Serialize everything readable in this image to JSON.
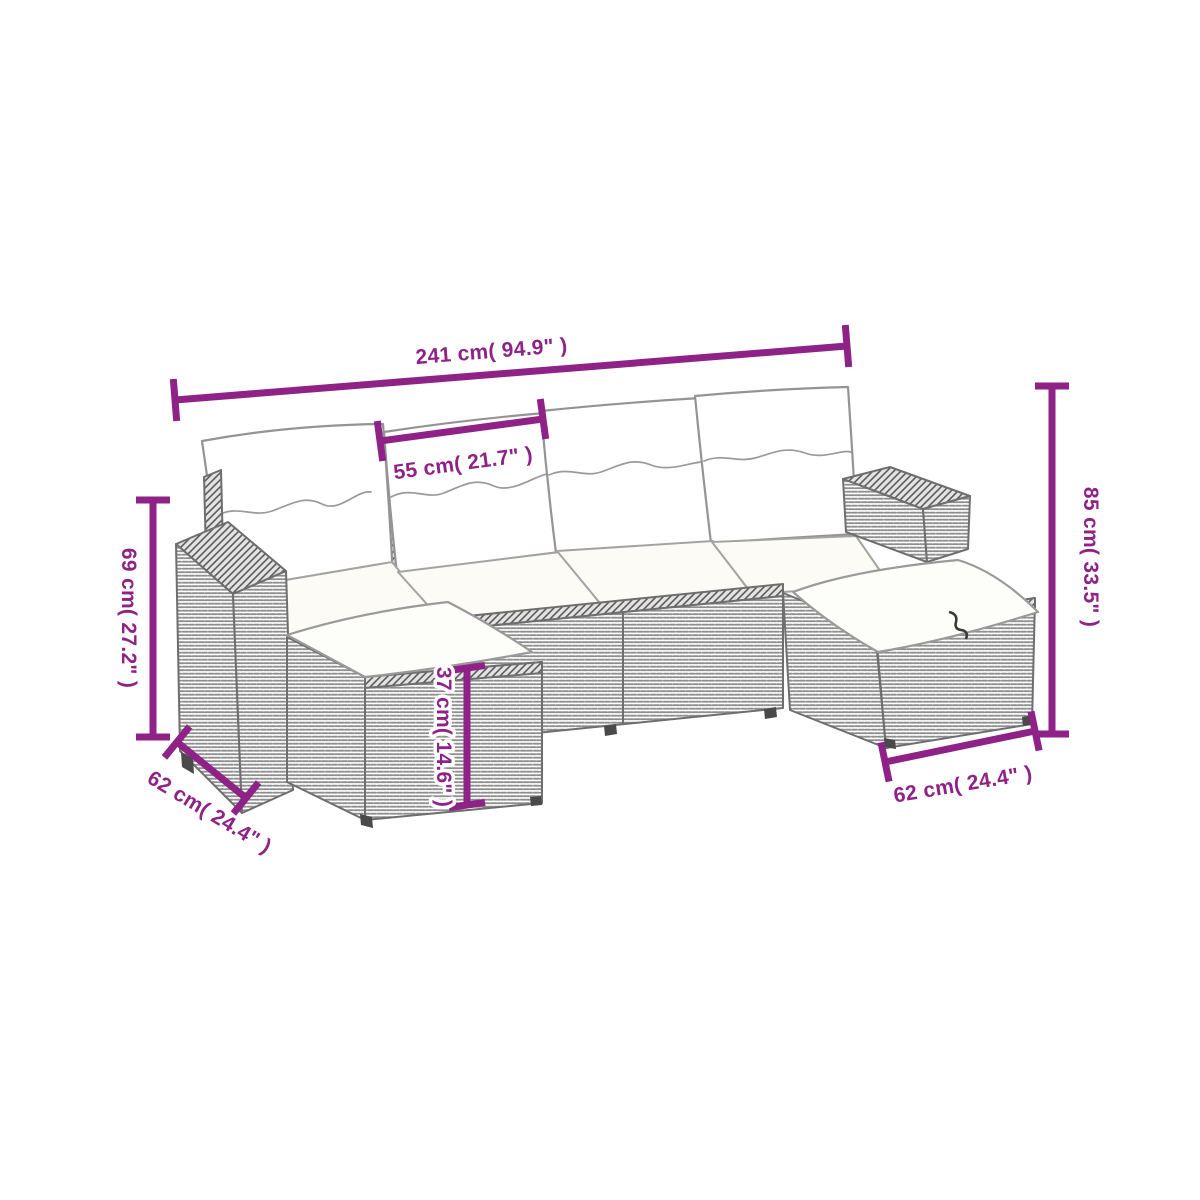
{
  "diagram": {
    "type": "product-dimension-diagram",
    "subject": "rattan-garden-sofa-set-with-cushions",
    "background_color": "#ffffff",
    "accent_color": "#8e2287",
    "dimensions": {
      "overall_width": "241 cm( 94.9\" )",
      "seat_width": "55 cm( 21.7\" )",
      "back_height": "69 cm( 27.2\" )",
      "overall_height": "85 cm( 33.5\" )",
      "stool_height": "37 cm( 14.6\" )",
      "left_depth": "62 cm( 24.4\" )",
      "right_depth": "62 cm( 24.4\" )"
    }
  }
}
